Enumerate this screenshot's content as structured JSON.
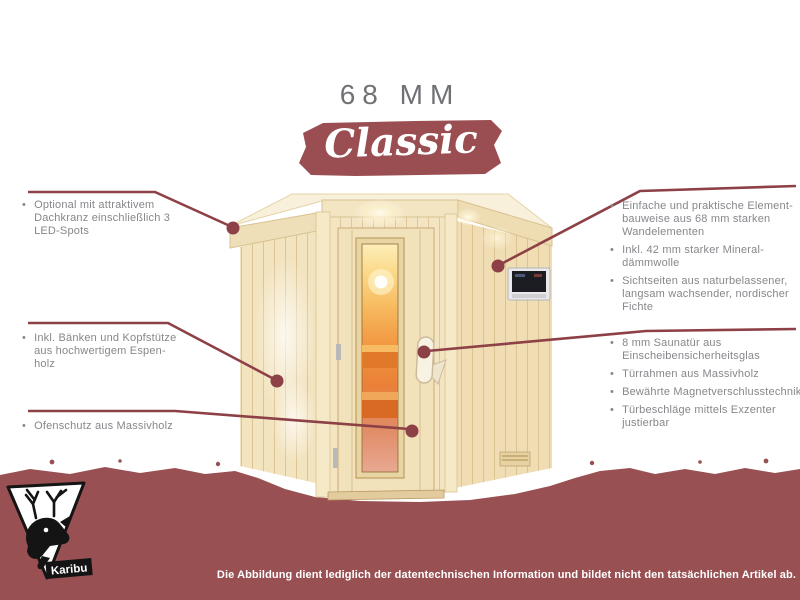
{
  "header": {
    "title": "68 MM",
    "badge": "Classic"
  },
  "annotations": {
    "left": [
      {
        "items": [
          "Optional mit attraktivem Dachkranz einschließlich 3 LED-Spots"
        ]
      },
      {
        "items": [
          "Inkl. Bänken und Kopfstütze aus hochwertigem Espen-holz"
        ]
      },
      {
        "items": [
          "Ofenschutz aus Massivholz"
        ]
      }
    ],
    "right": [
      {
        "items": [
          "Einfache und praktische Element-bauweise aus 68 mm starken Wandelementen",
          "Inkl. 42 mm starker Mineral-dämmwolle",
          "Sichtseiten aus naturbelassener, langsam wachsender, nordischer Fichte"
        ]
      },
      {
        "items": [
          "8 mm Saunatür aus Einscheibensicherheitsglas",
          "Türrahmen aus Massivholz",
          "Bewährte Magnetverschlusstechnik",
          "Türbeschläge mittels Exzenter justierbar"
        ]
      }
    ]
  },
  "footer": {
    "disclaimer": "Die Abbildung dient lediglich der datentechnischen Information und bildet nicht den tatsächlichen Artikel ab."
  },
  "logo": {
    "brand": "Karibu"
  },
  "ui": {
    "bullet": "•"
  },
  "colors": {
    "maroon_band": "#985053",
    "banner_maroon": "#9a4e51",
    "leader_line": "#8d4046",
    "text_gray": "#86878b",
    "title_gray": "#6f7175",
    "wood_light": "#f3e4c0",
    "glass_glow": "#f1963f"
  }
}
